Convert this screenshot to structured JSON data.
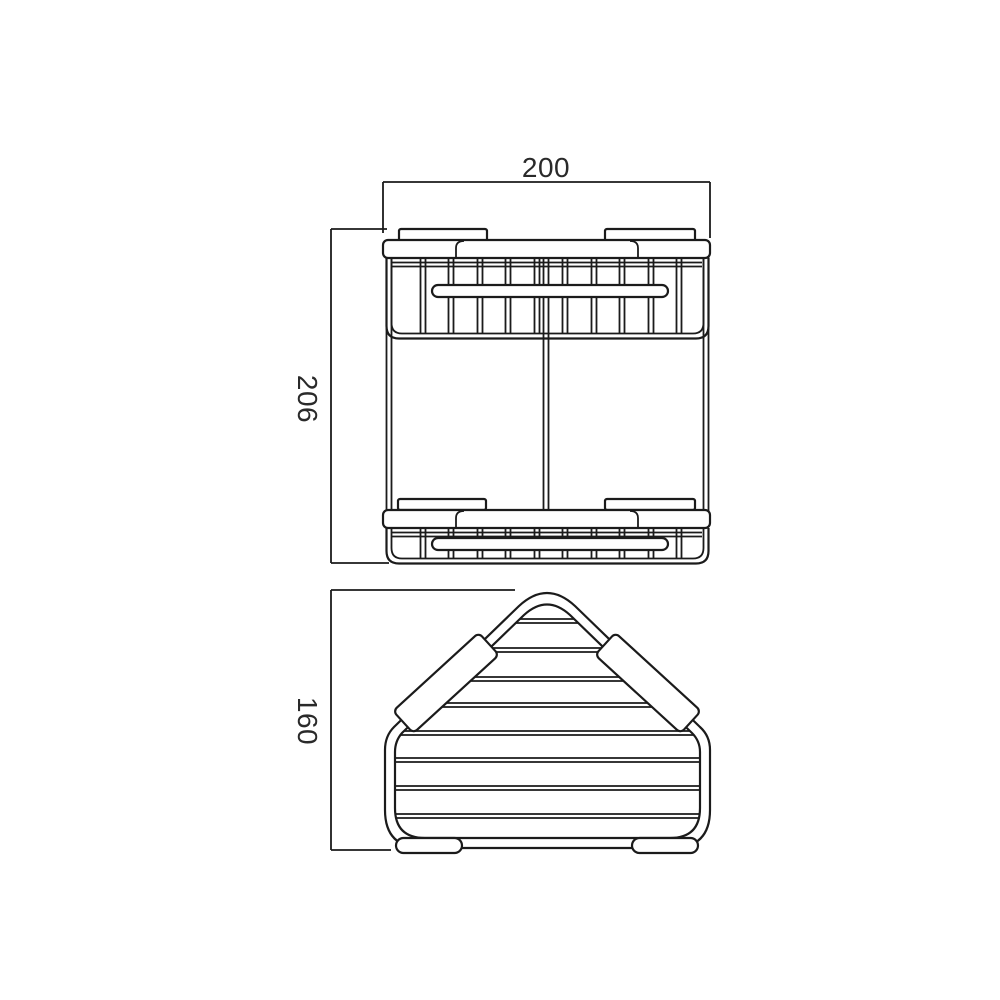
{
  "figure": {
    "kind": "technical-dimension-drawing",
    "subject": "two-tier corner wire basket",
    "background_color": "#ffffff",
    "line_color": "#1b1b1b",
    "text_color": "#2a2a2a"
  },
  "views": {
    "front": {
      "name": "front-elevation",
      "dimensions": {
        "width": {
          "label": "200",
          "orientation": "horizontal"
        },
        "height": {
          "label": "206",
          "orientation": "vertical"
        }
      }
    },
    "plan": {
      "name": "plan-view",
      "dimensions": {
        "depth": {
          "label": "160",
          "orientation": "vertical"
        }
      }
    }
  }
}
